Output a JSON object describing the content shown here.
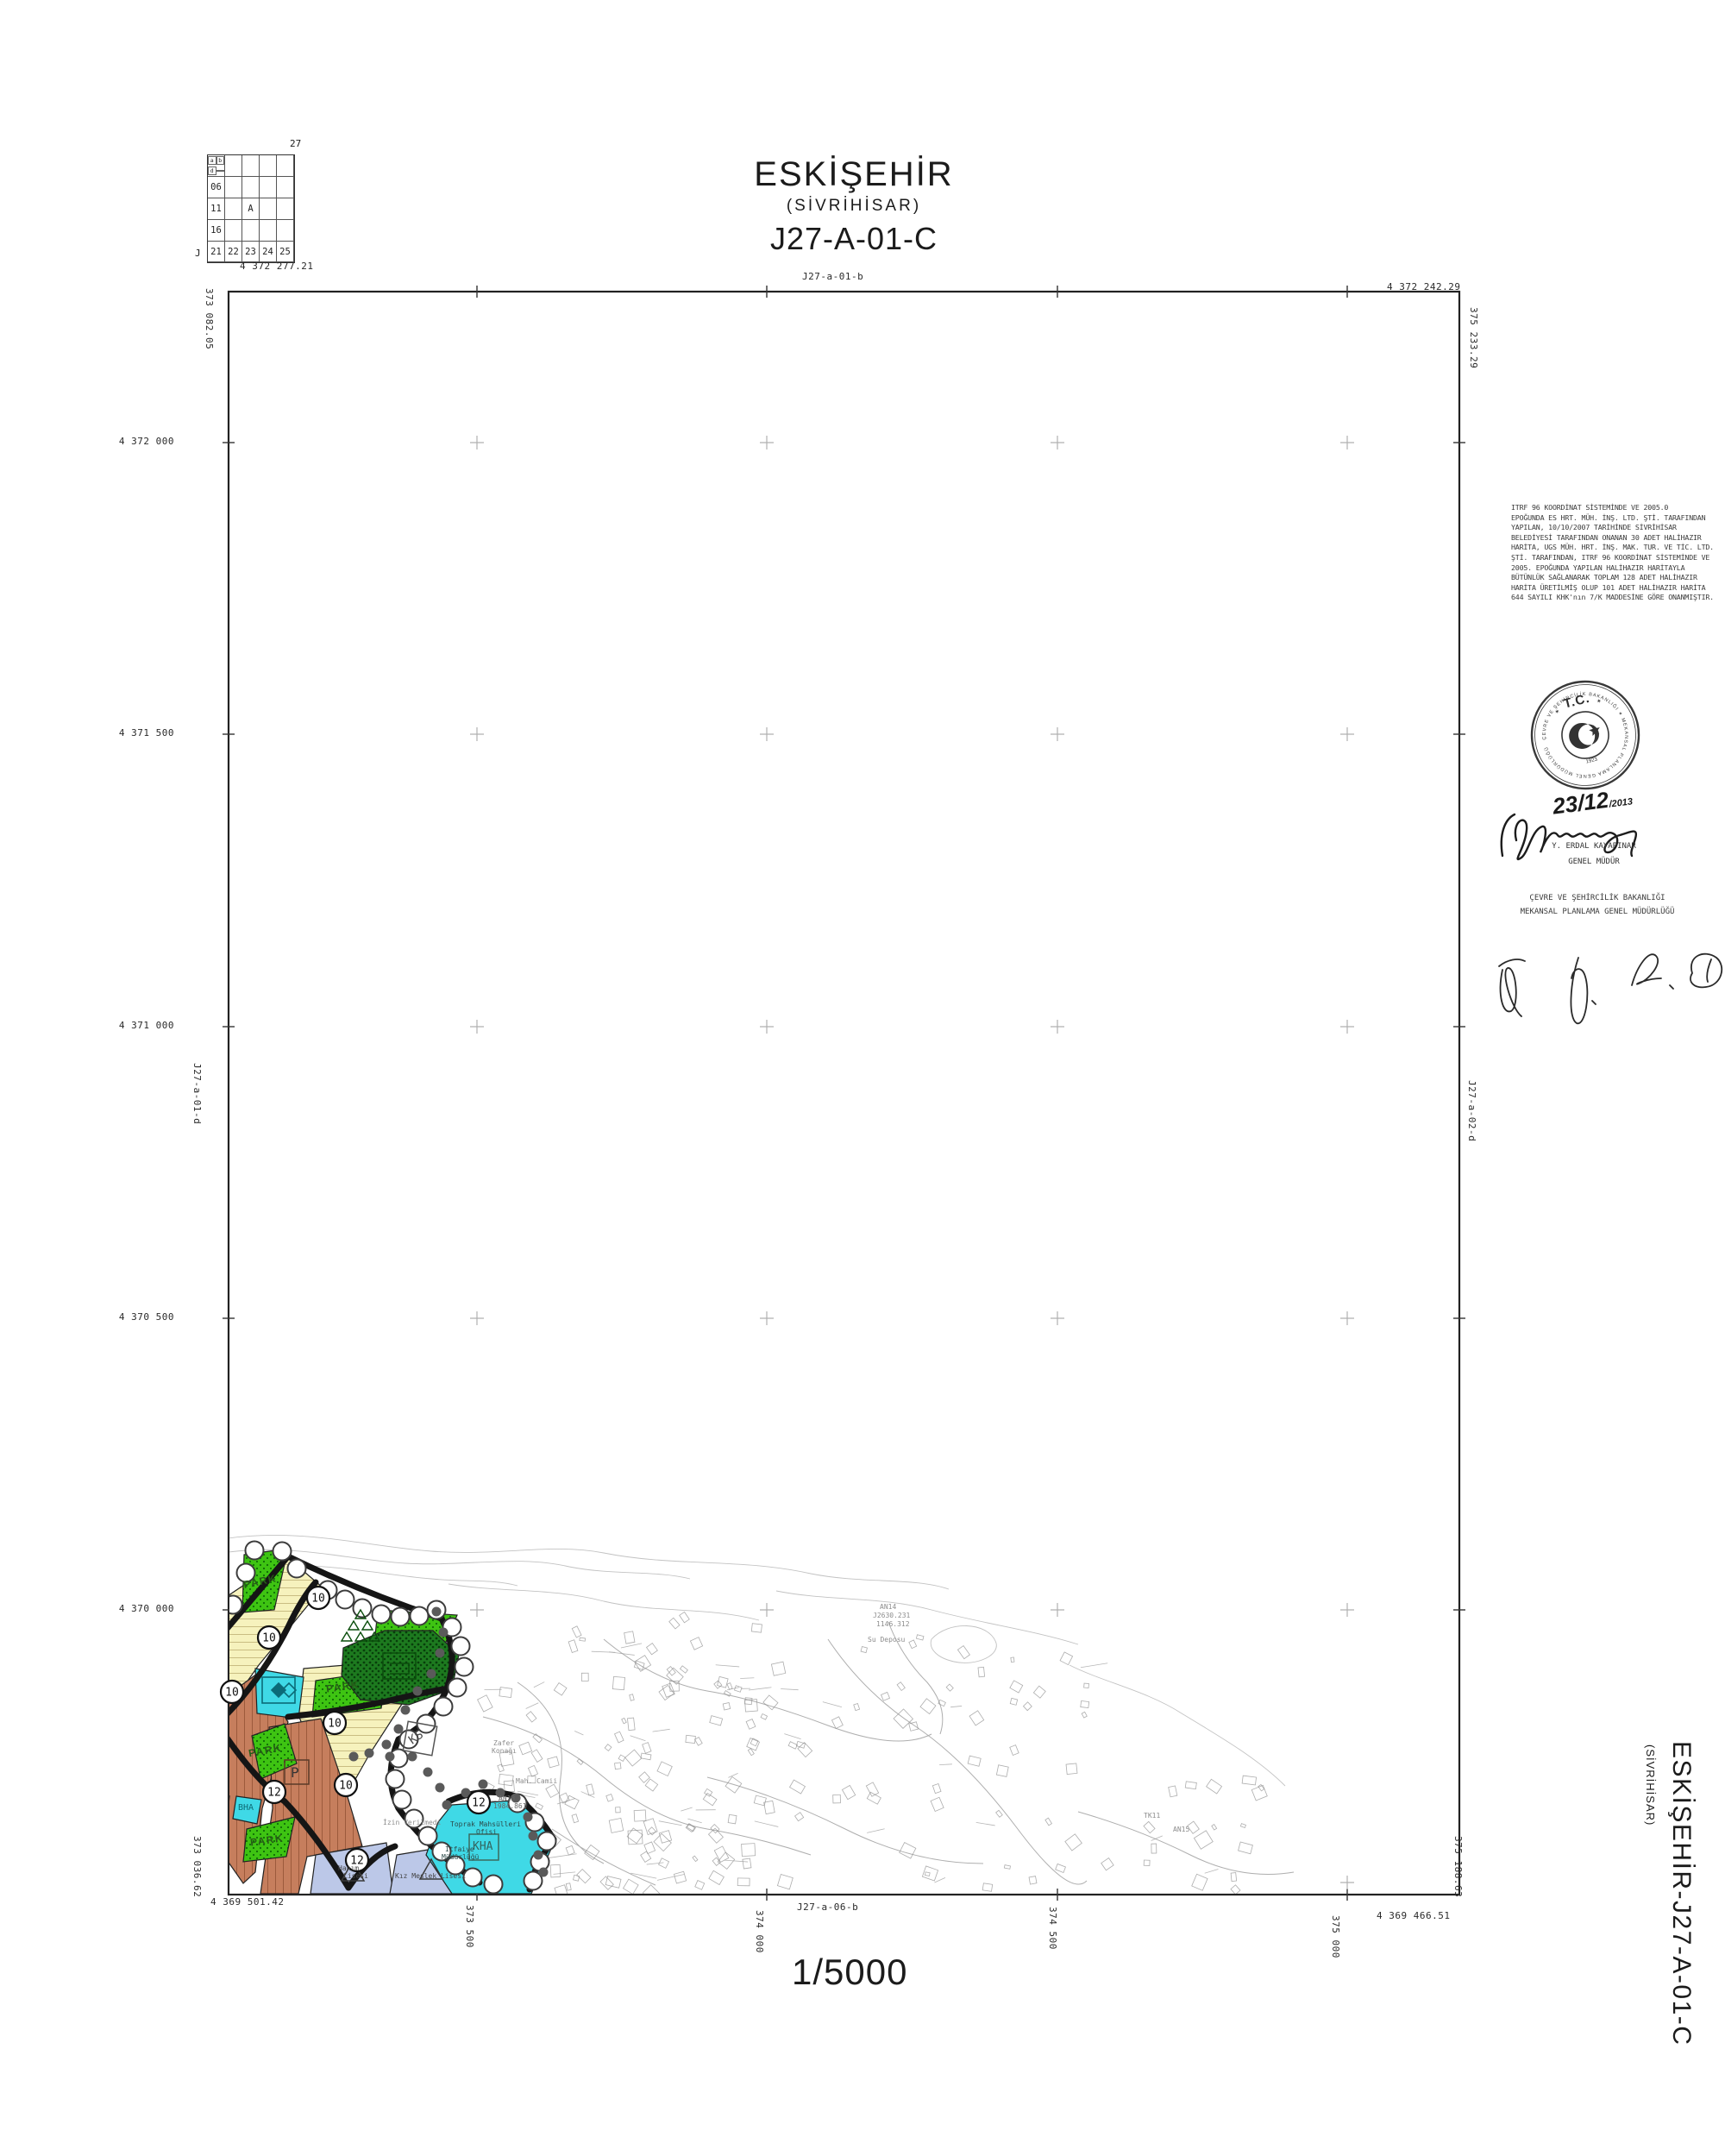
{
  "locator": {
    "corner_number": "27",
    "corner_letter": "J",
    "row_labels": [
      "06",
      "11",
      "16"
    ],
    "bottom_row": [
      "21",
      "22",
      "23",
      "24",
      "25"
    ],
    "cell_a": "A",
    "quarter_labels": [
      "a",
      "b",
      "d"
    ]
  },
  "title": {
    "city": "ESKİŞEHİR",
    "district": "(SİVRİHİSAR)",
    "sheet": "J27-A-01-C"
  },
  "frame": {
    "top_left": "4 372 277.21",
    "top_center": "J27-a-01-b",
    "top_right": "4 372 242.29",
    "left_top": "373 082.05",
    "right_top": "375 233.29",
    "left_mid": "J27-a-01-d",
    "right_mid": "J27-a-02-d",
    "left_bottom": "373 036.62",
    "right_bottom": "375 188.63",
    "bottom_left": "4 369 501.42",
    "bottom_center": "J27-a-06-b",
    "bottom_right": "4 369 466.51",
    "left_labels": [
      "4 372 000",
      "4 371 500",
      "4 371 000",
      "4 370 500",
      "4 370 000"
    ],
    "bottom_labels": [
      "373 500",
      "374 000",
      "374 500",
      "375 000"
    ],
    "scale": "1/5000"
  },
  "notes": {
    "lines": [
      "ITRF 96 KOORDİNAT SİSTEMİNDE VE 2005.0",
      "EPOĞUNDA ES HRT. MÜH. İNŞ. LTD. ŞTİ. TARAFINDAN",
      "YAPILAN, 10/10/2007 TARİHİNDE SİVRİHİSAR",
      "BELEDİYESİ TARAFINDAN ONANAN 30 ADET HALİHAZIR",
      "HARİTA, UGS MÜH. HRT. İNŞ. MAK. TUR. VE TİC. LTD.",
      "ŞTİ. TARAFINDAN, ITRF 96 KOORDİNAT SİSTEMİNDE VE",
      "2005. EPOĞUNDA YAPILAN HALİHAZIR HARİTAYLA",
      "BÜTÜNLÜK SAĞLANARAK TOPLAM 128 ADET HALİHAZIR",
      "HARİTA ÜRETİLMİŞ OLUP 101 ADET HALİHAZIR HARİTA",
      "644 SAYILI KHK'nın 7/K MADDESİNE GÖRE ONANMIŞTIR."
    ]
  },
  "stamp": {
    "tc": "T.C.",
    "year": "1923",
    "ring_text": "ÇEVRE VE ŞEHİRCİLİK BAKANLIĞI ✶ MEKANSAL PLANLAMA GENEL MÜDÜRLÜĞÜ ✶",
    "date_main": "23/12",
    "date_year": "/2013"
  },
  "approval": {
    "name": "Y. ERDAL KAYAPINAR",
    "title": "GENEL MÜDÜR",
    "ministry_line1": "ÇEVRE VE ŞEHİRCİLİK BAKANLIĞI",
    "ministry_line2": "MEKANSAL PLANLAMA GENEL MÜDÜRLÜĞÜ"
  },
  "side_label": {
    "main": "ESKİŞEHİR-J27-A-01-C",
    "sub": "(SİVRİHİSAR)"
  },
  "map": {
    "park_labels": [
      "PARK",
      "PARK",
      "PARK",
      "PARK"
    ],
    "road_circles": [
      "10",
      "10",
      "10",
      "10",
      "10",
      "12",
      "12",
      "12"
    ],
    "zone_codes": {
      "bha": "BHA",
      "kha": "KHA",
      "ks": "KS",
      "parking": "P"
    },
    "poi": {
      "su_deposu": "Su Deposu",
      "an14": "AN14",
      "an14_code": "J2630.231",
      "an14_elev": "1146.312",
      "tk11": "TK11",
      "an15": "AN15",
      "zafer1": "Zafer",
      "zafer2": "Konağı",
      "izin": "İzin Verilmedi",
      "camii": "Mah. Camii",
      "toprak": "Toprak Mahsülleri",
      "ofisi": "Ofisi",
      "itfaiye": "İtfaiye",
      "mudurlugu": "Müdürlüğü",
      "an13": "AN13",
      "an13_elev": "1984.861",
      "school1a": "Hanım",
      "school1b": "Lisesi",
      "school2": "Kız Meslek Lisesi"
    },
    "colors": {
      "park_green": "#3ec412",
      "forest_green": "#1d7a1f",
      "residential_yellow": "#f6f2bd",
      "built_brown": "#c67e5d",
      "public_cyan": "#3fd9e6",
      "school_blue": "#bcc8e8",
      "road_black": "#151515"
    }
  }
}
